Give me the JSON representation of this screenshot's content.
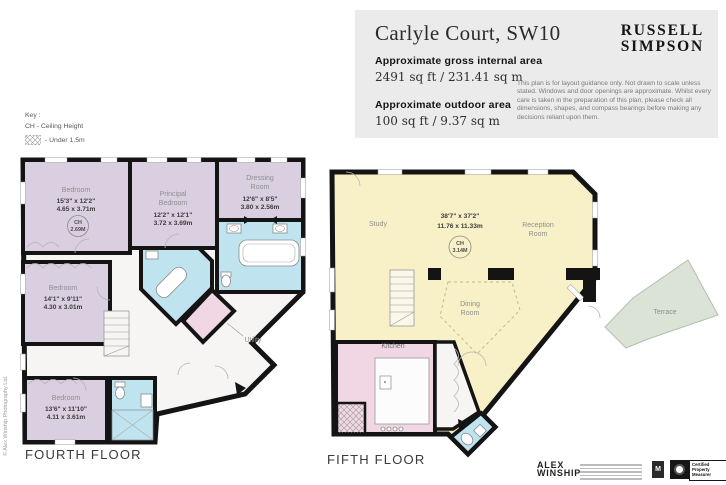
{
  "header": {
    "title": "Carlyle Court, SW10",
    "gross_area_label": "Approximate gross internal area",
    "gross_area_value": "2491 sq ft / 231.41 sq m",
    "outdoor_area_label": "Approximate outdoor area",
    "outdoor_area_value": "100 sq ft / 9.37 sq m",
    "brand_line1": "RUSSELL",
    "brand_line2": "SIMPSON",
    "disclaimer": "This plan is for layout guidance only. Not drawn to scale unless stated. Windows and door openings are approximate. Whilst every care is taken in the preparation of this plan, please check all dimensions, shapes, and compass bearings before making any decisions reliant upon them."
  },
  "key": {
    "title": "Key :",
    "ch_label": "CH - Ceiling Height",
    "under_label": "- Under 1.5m"
  },
  "fourth_floor": {
    "label": "FOURTH FLOOR",
    "bedroom1": {
      "name": "Bedroom",
      "dims_ft": "15'3\" x 12'2\"",
      "dims_m": "4.65 x 3.71m",
      "ch": "CH",
      "ch_value": "2.69M"
    },
    "principal": {
      "line1": "Principal",
      "line2": "Bedroom",
      "dims_ft": "12'2\" x 12'1\"",
      "dims_m": "3.72 x 3.69m"
    },
    "dressing": {
      "line1": "Dressing",
      "line2": "Room",
      "dims_ft": "12'6\" x 8'5\"",
      "dims_m": "3.80 x 2.56m"
    },
    "bedroom2": {
      "name": "Bedroom",
      "dims_ft": "14'1\" x 9'11\"",
      "dims_m": "4.30 x 3.01m"
    },
    "bedroom3": {
      "name": "Bedroom",
      "dims_ft": "13'6\" x 11'10\"",
      "dims_m": "4.11 x 3.61m"
    },
    "utility": "Utility"
  },
  "fifth_floor": {
    "label": "FIFTH FLOOR",
    "study": "Study",
    "open_plan": {
      "dims_ft": "38'7\" x 37'2\"",
      "dims_m": "11.76 x 11.33m",
      "ch": "CH",
      "ch_value": "3.14M"
    },
    "reception": {
      "line1": "Reception",
      "line2": "Room"
    },
    "dining": {
      "line1": "Dining",
      "line2": "Room"
    },
    "kitchen": "Kitchen",
    "terrace": "Terrace"
  },
  "footer": {
    "credit": "© Alex Winship Photography Ltd.",
    "brand_line1": "ALEX",
    "brand_line2": "WINSHIP",
    "badge_m": "M",
    "badge_certified": "Certified Property Measurer"
  },
  "colors": {
    "bedroom": "#d9cfe0",
    "bathroom": "#bfe4ef",
    "kitchen_utility": "#f1d6e3",
    "living": "#f8f0c6",
    "terrace": "#dbe3d6",
    "hallway": "#f6f5f3",
    "wall": "#141414",
    "header_panel": "#ebebeb"
  }
}
